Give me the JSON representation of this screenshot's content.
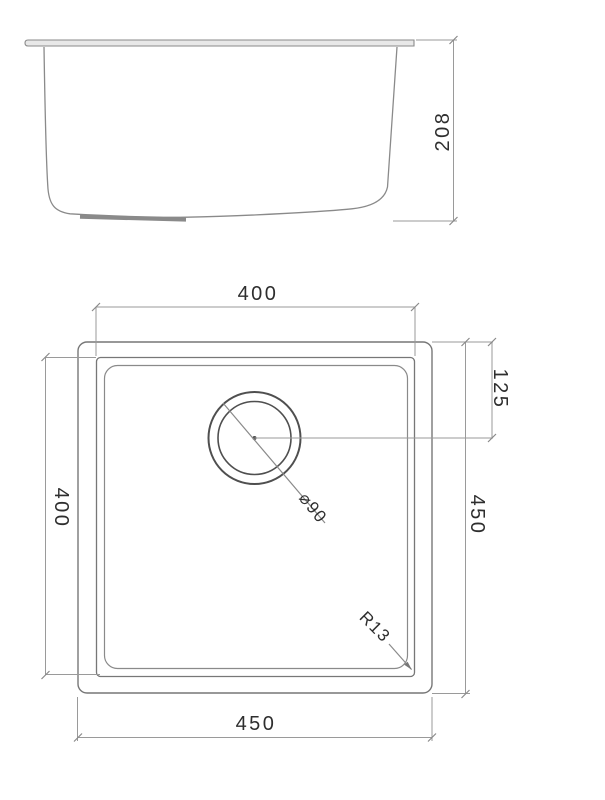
{
  "drawing": {
    "side_view": {
      "height": "208"
    },
    "plan_view": {
      "inner_width_top": "400",
      "inner_height_left": "400",
      "outer_width_bottom": "450",
      "outer_height_right": "450",
      "drain_center_offset": "125",
      "drain_diameter": "⌀90",
      "corner_radius": "R13"
    },
    "colors": {
      "background": "#ffffff",
      "line": "#8a8a8a",
      "line_dark": "#4f4f4f",
      "dim_line": "#9a9a9a",
      "text": "#2e2e2e"
    }
  }
}
